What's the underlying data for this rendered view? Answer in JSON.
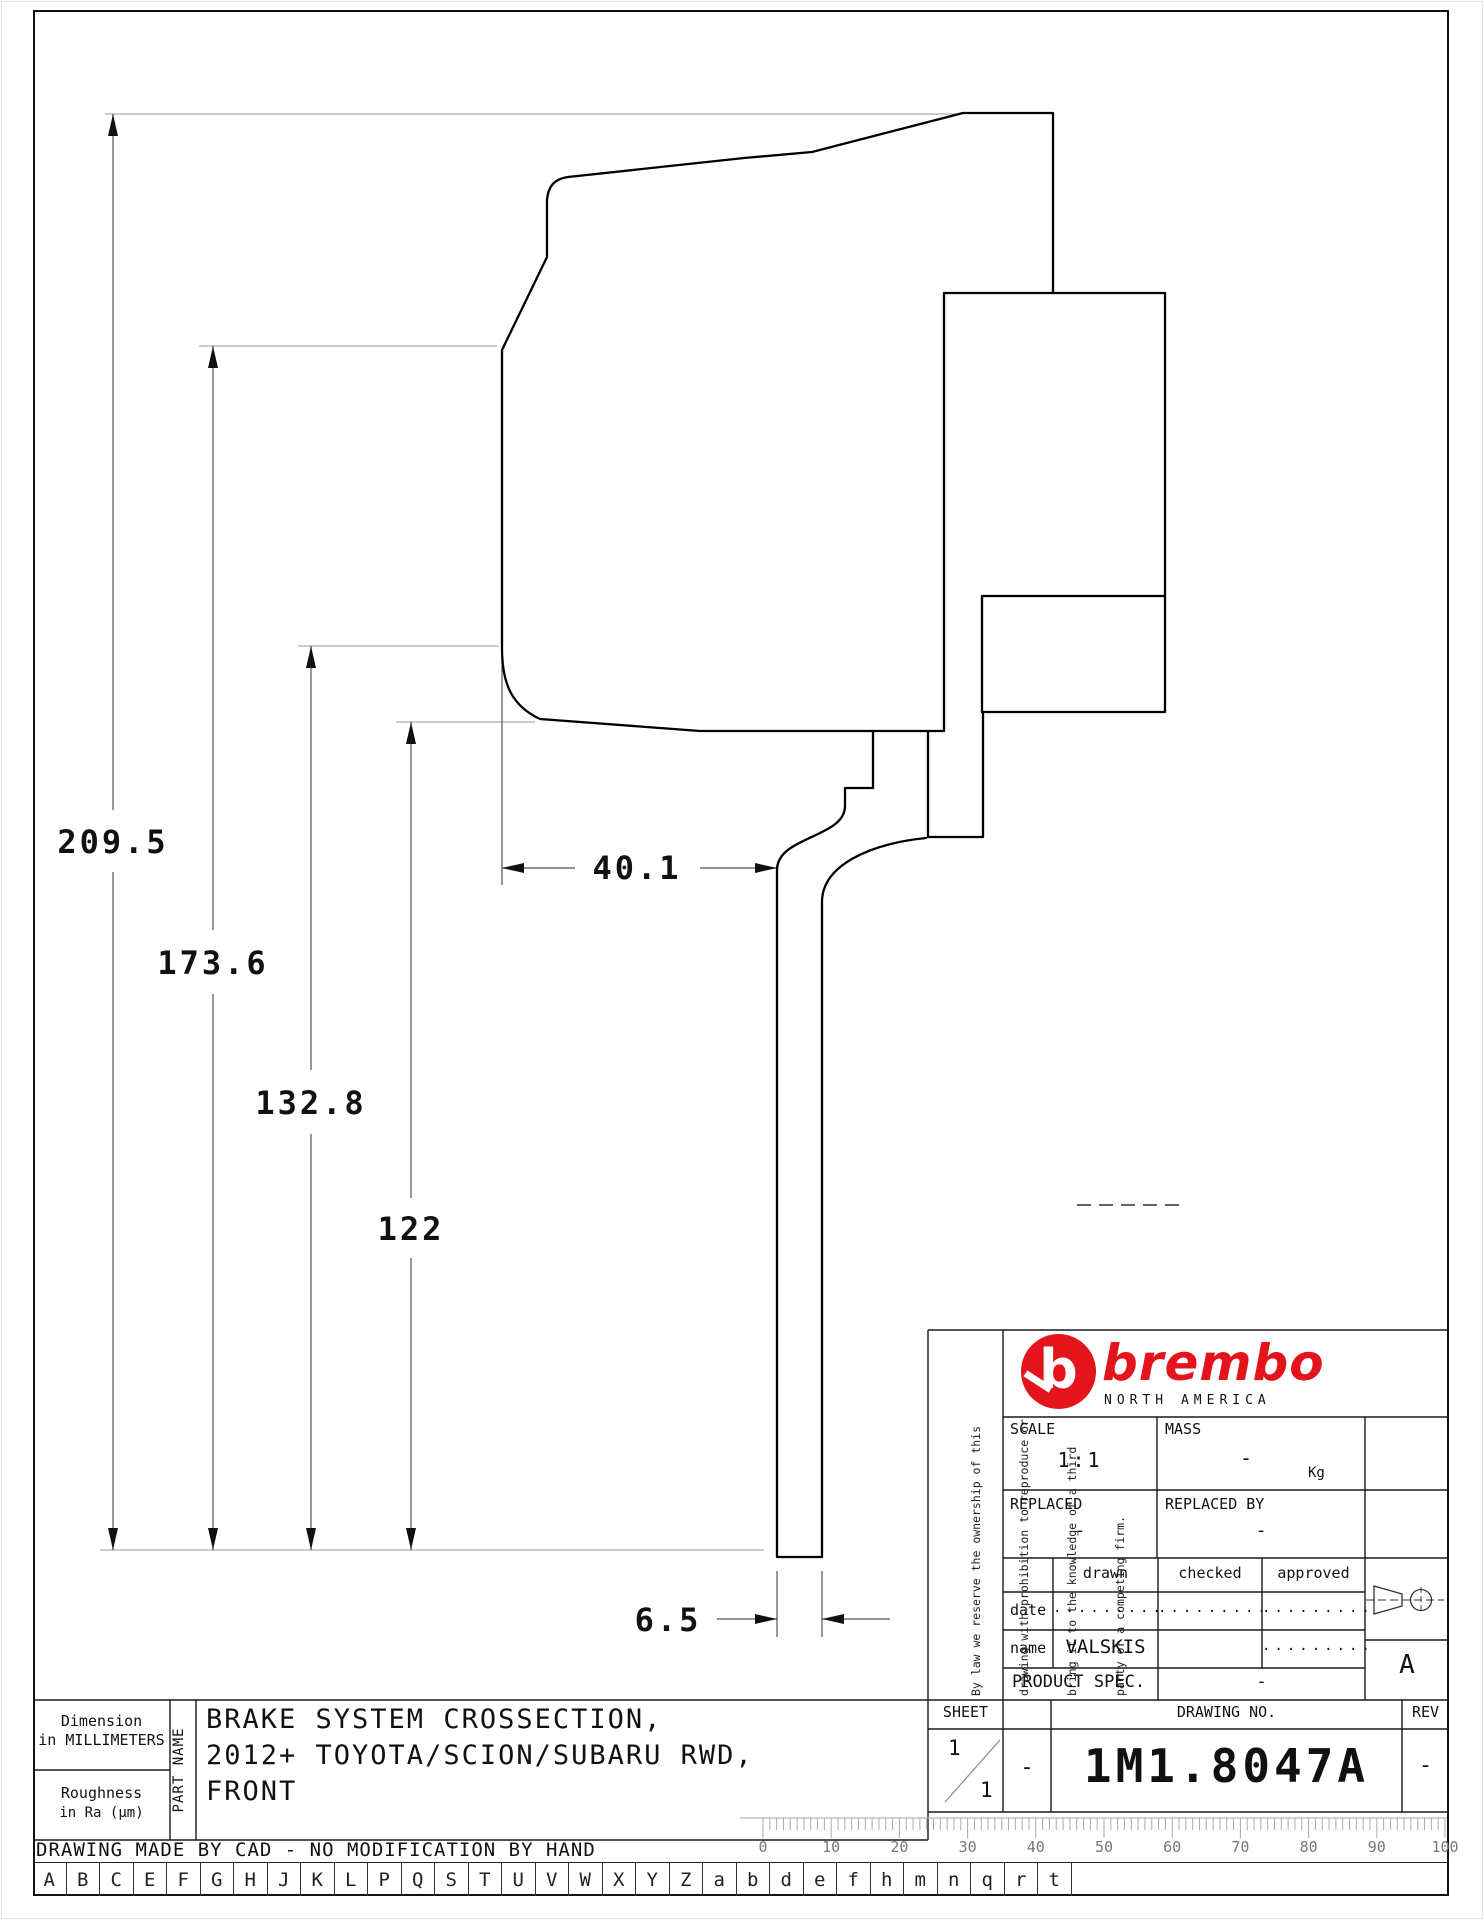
{
  "drawing": {
    "dim_overall": "209.5",
    "dim_hat_depth": "173.6",
    "dim_mid": "132.8",
    "dim_inner": "122",
    "dim_width": "40.1",
    "dim_thickness": "6.5"
  },
  "title_block": {
    "disclaimer_lines": [
      "By law we reserve the ownership of this",
      "drawing with prohibition to reproduce or",
      "bring it to the knowledge of a third",
      "party or a competing firm."
    ],
    "brand": "brembo",
    "brand_initial": "b",
    "brand_sub": "NORTH AMERICA",
    "scale_label": "SCALE",
    "scale_value": "1:1",
    "mass_label": "MASS",
    "mass_value": "-",
    "mass_unit": "Kg",
    "replaced_label": "REPLACED",
    "replaced_value": "-",
    "replaced_by_label": "REPLACED BY",
    "replaced_by_value": "-",
    "col_drawn": "drawn",
    "col_checked": "checked",
    "col_approved": "approved",
    "row_date": "date",
    "row_name": "name",
    "dots": ".........",
    "name_value": "VALSKIS",
    "product_spec_label": "PRODUCT SPEC.",
    "product_spec_value": "-",
    "sheet_label": "SHEET",
    "sheet_num": "1",
    "sheet_total": "1",
    "sheet_dash": "-",
    "drawing_no_label": "DRAWING NO.",
    "drawing_no": "1M1.8047A",
    "rev_label": "REV",
    "rev_value": "-",
    "projection_letter": "A"
  },
  "part_block": {
    "dim_note_1": "Dimension",
    "dim_note_2": "in MILLIMETERS",
    "rough_note_1": "Roughness",
    "rough_note_2": "in Ra (µm)",
    "part_name_label": "PART NAME",
    "title_line_1": "BRAKE SYSTEM CROSSECTION,",
    "title_line_2": "2012+ TOYOTA/SCION/SUBARU RWD,",
    "title_line_3": "FRONT"
  },
  "footer": {
    "cad_note": "DRAWING MADE BY CAD - NO MODIFICATION BY HAND"
  },
  "ruler": {
    "labels": [
      "0",
      "10",
      "20",
      "30",
      "40",
      "50",
      "60",
      "70",
      "80",
      "90",
      "100"
    ]
  },
  "letters": [
    "A",
    "B",
    "C",
    "E",
    "F",
    "G",
    "H",
    "J",
    "K",
    "L",
    "P",
    "Q",
    "S",
    "T",
    "U",
    "V",
    "W",
    "X",
    "Y",
    "Z",
    "a",
    "b",
    "d",
    "e",
    "f",
    "h",
    "m",
    "n",
    "q",
    "r",
    "t"
  ],
  "colors": {
    "accent_red": "#e4141c",
    "line_black": "#000000"
  }
}
